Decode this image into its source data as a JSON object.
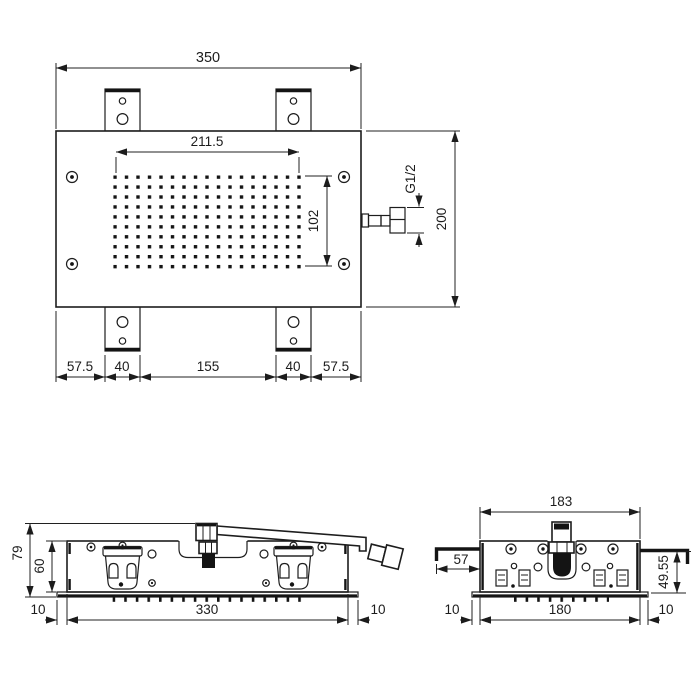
{
  "colors": {
    "line": "#1d1d1d",
    "fill": "#141414",
    "background": "#ffffff"
  },
  "top_view": {
    "overall_width": "350",
    "spray_field_width": "211.5",
    "spray_field_height": "102",
    "thread_label": "G1/2",
    "overall_depth": "200",
    "chain": [
      "57.5",
      "40",
      "155",
      "40",
      "57.5"
    ]
  },
  "side_view": {
    "overall_height": "79",
    "body_height": "60",
    "left_offset": "10",
    "body_length": "330",
    "right_offset": "10"
  },
  "end_view": {
    "overall_width": "183",
    "arm_length": "57",
    "install_height": "49.55",
    "left_offset": "10",
    "body_width": "180",
    "right_offset": "10"
  }
}
